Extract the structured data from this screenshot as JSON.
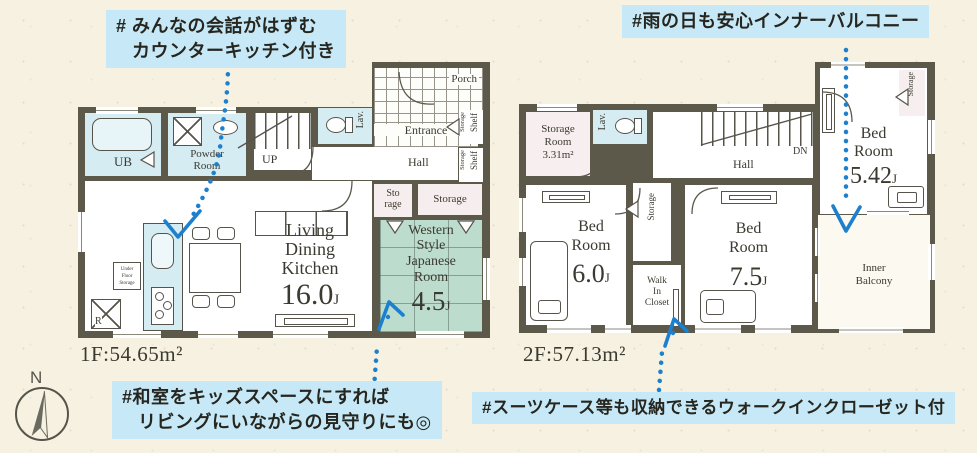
{
  "colors": {
    "background": "#f6f1e0",
    "wall": "#5c594b",
    "highlight": "#c7e9f7",
    "room_blue": "#d6ecf3",
    "room_green": "#bcdccd",
    "room_pink": "#f6eeee",
    "accent_blue": "#1d80ce",
    "ink": "#3b3a30"
  },
  "annotations": {
    "counter_kitchen": {
      "line1": "# みんなの会話がはずむ",
      "line2": "カウンターキッチン付き"
    },
    "inner_balcony": {
      "line1": "#雨の日も安心インナーバルコニー"
    },
    "kids_space": {
      "line1": "#和室をキッズスペースにすれば",
      "line2": "リビングにいながらの見守りにも◎"
    },
    "walk_in_closet": {
      "line1": "#スーツケース等も収納できるウォークインクローゼット付"
    }
  },
  "compass": {
    "label": "N"
  },
  "floor1": {
    "area": "1F:54.65m²",
    "ub": "UB",
    "powder_line1": "Powder",
    "powder_line2": "Room",
    "up": "UP",
    "lav": "Lav.",
    "porch": "Porch",
    "entrance": "Entrance",
    "hall": "Hall",
    "shelf1_storage": "Storage",
    "shelf1": "Shelf",
    "shelf2_storage": "Storage",
    "shelf2": "Shelf",
    "storage_small_line1": "Sto",
    "storage_small_line2": "rage",
    "storage": "Storage",
    "ldk_line1": "Living",
    "ldk_line2": "Dining",
    "ldk_line3": "Kitchen",
    "ldk_size": "16.0",
    "ldk_unit": "J",
    "wj_line1": "Western",
    "wj_line2": "Style",
    "wj_line3": "Japanese",
    "wj_line4": "Room",
    "wj_size": "4.5",
    "wj_unit": "J",
    "ufs_line1": "Under",
    "ufs_line2": "Floor",
    "ufs_line3": "Storage",
    "refrigerator": "R"
  },
  "floor2": {
    "area": "2F:57.13m²",
    "storage_room_line1": "Storage",
    "storage_room_line2": "Room",
    "storage_room_line3": "3.31m²",
    "lav": "Lav.",
    "hall": "Hall",
    "dn": "DN",
    "bedroom1_line1": "Bed",
    "bedroom1_line2": "Room",
    "bedroom1_size": "5.42",
    "bedroom1_unit": "J",
    "bedroom1_storage": "Storage",
    "bedroom2_line1": "Bed",
    "bedroom2_line2": "Room",
    "bedroom2_size": "6.0",
    "bedroom2_unit": "J",
    "storage": "Storage",
    "wic_line1": "Walk",
    "wic_line2": "In",
    "wic_line3": "Closet",
    "bedroom3_line1": "Bed",
    "bedroom3_line2": "Room",
    "bedroom3_size": "7.5",
    "bedroom3_unit": "J",
    "balcony_line1": "Inner",
    "balcony_line2": "Balcony"
  }
}
